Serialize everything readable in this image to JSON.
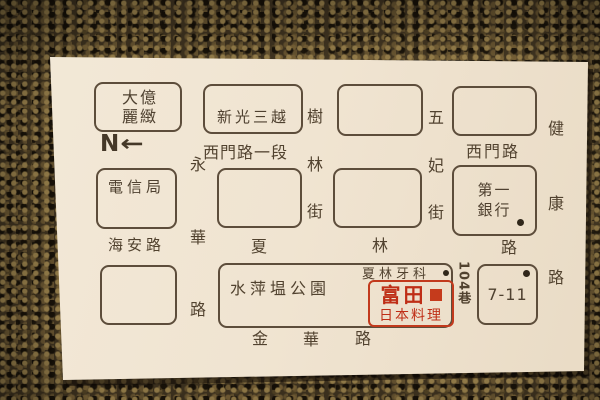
{
  "card": {
    "compass": {
      "n": "N",
      "arrow": "←"
    },
    "boxes": {
      "hotel": {
        "line1": "大億",
        "line2": "麗緻"
      },
      "department_store": {
        "label": "新光三越"
      },
      "telecom": {
        "label": "電信局"
      },
      "bank": {
        "line1": "第一",
        "line2": "銀行"
      },
      "seven_eleven": {
        "label": "7-11"
      },
      "park": {
        "label": "水萍塭公園"
      },
      "dental": {
        "label": "夏林牙科"
      },
      "restaurant": {
        "name": "富田",
        "subtitle": "日本料理"
      }
    },
    "streets": {
      "ximen_sec1": "西門路一段",
      "ximen": "西門路",
      "haian": "海安路",
      "lane104": "104巷",
      "shulin": [
        "樹",
        "林",
        "街"
      ],
      "wufei": [
        "五",
        "妃",
        "街"
      ],
      "jiankang": [
        "健",
        "康",
        "路"
      ],
      "yonghua": [
        "永",
        "華",
        "路"
      ],
      "xialin": [
        "夏",
        "林",
        "路"
      ],
      "jinhua": [
        "金",
        "華",
        "路"
      ]
    },
    "colors": {
      "ink": "#51422f",
      "restaurant_red": "#bf2e16",
      "card_bg": "#f0e4d1",
      "carpet_base": "#453823"
    }
  }
}
